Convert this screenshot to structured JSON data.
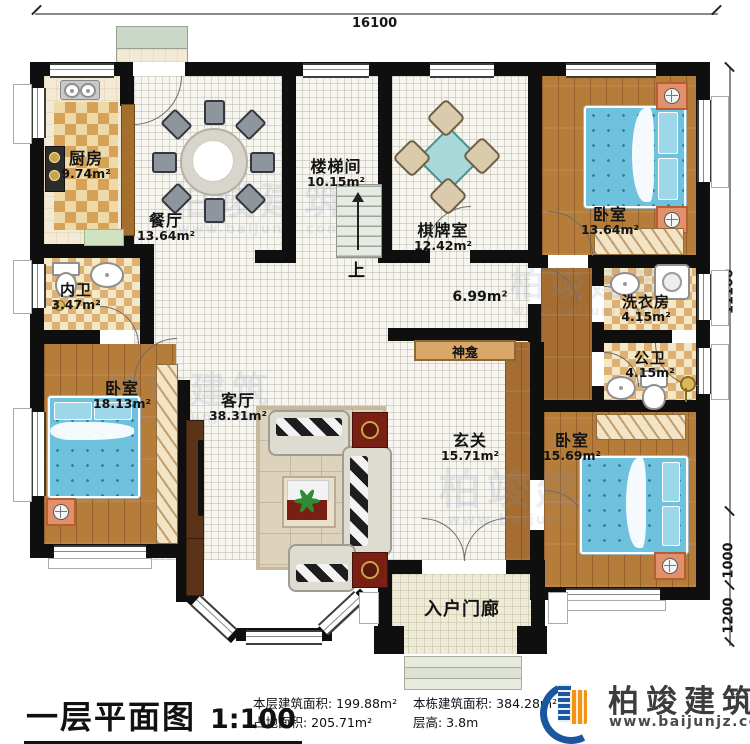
{
  "plan": {
    "dimensions": {
      "top": "16100",
      "right_upper": "11100",
      "right_mid": "1000",
      "right_lower": "1200"
    },
    "rooms": [
      {
        "name": "厨房",
        "area": "9.74m²"
      },
      {
        "name": "餐厅",
        "area": "13.64m²"
      },
      {
        "name": "楼梯间",
        "area": "10.15m²"
      },
      {
        "name": "棋牌室",
        "area": "12.42m²"
      },
      {
        "name": "卧室",
        "area": "13.64m²"
      },
      {
        "name": "洗衣房",
        "area": "4.15m²"
      },
      {
        "name": "公卫",
        "area": "4.15m²"
      },
      {
        "name": "内卫",
        "area": "3.47m²"
      },
      {
        "name": "卧室",
        "area": "18.13m²"
      },
      {
        "name": "客厅",
        "area": "38.31m²"
      },
      {
        "name": "玄关",
        "area": "15.71m²"
      },
      {
        "name": "卧室",
        "area": "15.69m²"
      }
    ],
    "corridor_area": "6.99m²",
    "labels": {
      "shrine": "神龛",
      "stairs_up": "上",
      "porch": "入户门廊"
    }
  },
  "watermark": {
    "brand": "柏竣建筑",
    "url": "www.baijunjz.com"
  },
  "footer": {
    "title": "一层平面图",
    "scale": "1:100",
    "stat_floor_area": "本层建筑面积: 199.88m²",
    "stat_footprint": "占地面积: 205.71m²",
    "stat_total_area": "本栋建筑面积: 384.28m²",
    "stat_height": "层高: 3.8m",
    "brand": "柏竣建筑",
    "url": "www.baijunjz.com"
  },
  "colors": {
    "wall": "#0f0f0f",
    "wood": "#b57c3a",
    "bed_blue": "#6fc2de",
    "accent_orange": "#f39416",
    "accent_blue": "#1a57a0"
  }
}
